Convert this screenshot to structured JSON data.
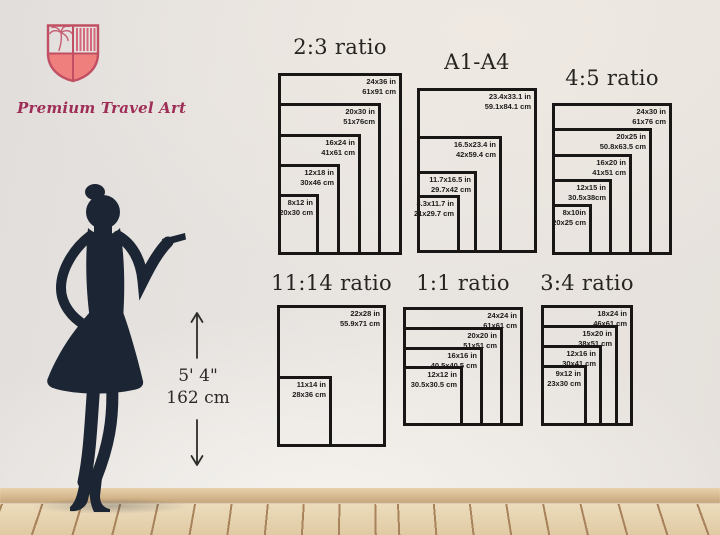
{
  "logo": {
    "brand": "Premium Travel Art",
    "icon": "shield-with-palm-tree-and-stripes",
    "shield_fill": "#ee7f7d",
    "shield_outline": "#c14f63",
    "text_color": "#9e2e57"
  },
  "figure": {
    "description": "woman-silhouette",
    "height_imperial": "5' 4\"",
    "height_metric": "162 cm",
    "silhouette_color": "#1c2533"
  },
  "icons": {
    "arrow_up": "↑",
    "arrow_down": "↓",
    "palm_tree": "palm-sketch"
  },
  "colors": {
    "wall": "#e7e3e0",
    "chart_line": "#181716",
    "label_text": "#1c1b1a",
    "floor_wood": "#e6d3b0",
    "floor_seam": "#a8835c",
    "baseboard": "#d5b88e"
  },
  "charts": [
    {
      "title": "2:3 ratio",
      "layout": {
        "left": 278,
        "top": 73,
        "width": 124,
        "height": 182,
        "title_top": 35
      },
      "sizes": [
        {
          "in": "24x36 in",
          "cm": "61x91 cm",
          "w": 24,
          "h": 36
        },
        {
          "in": "20x30 in",
          "cm": "51x76cm",
          "w": 20,
          "h": 30
        },
        {
          "in": "16x24 in",
          "cm": "41x61 cm",
          "w": 16,
          "h": 24
        },
        {
          "in": "12x18 in",
          "cm": "30x46 cm",
          "w": 12,
          "h": 18
        },
        {
          "in": "8x12 in",
          "cm": "20x30 cm",
          "w": 8,
          "h": 12
        }
      ]
    },
    {
      "title": "A1-A4",
      "layout": {
        "left": 417,
        "top": 88,
        "width": 120,
        "height": 165,
        "title_top": 50
      },
      "sizes": [
        {
          "in": "23.4x33.1 in",
          "cm": "59.1x84.1 cm",
          "w": 23.4,
          "h": 33.1
        },
        {
          "in": "16.5x23.4 in",
          "cm": "42x59.4 cm",
          "w": 16.5,
          "h": 23.4
        },
        {
          "in": "11.7x16.5 in",
          "cm": "29.7x42 cm",
          "w": 11.7,
          "h": 16.5
        },
        {
          "in": "8.3x11.7 in",
          "cm": "21x29.7 cm",
          "w": 8.3,
          "h": 11.7
        }
      ]
    },
    {
      "title": "4:5 ratio",
      "layout": {
        "left": 552,
        "top": 103,
        "width": 120,
        "height": 152,
        "title_top": 66
      },
      "sizes": [
        {
          "in": "24x30 in",
          "cm": "61x76 cm",
          "w": 24,
          "h": 30
        },
        {
          "in": "20x25 in",
          "cm": "50.8x63.5 cm",
          "w": 20,
          "h": 25
        },
        {
          "in": "16x20 in",
          "cm": "41x51 cm",
          "w": 16,
          "h": 20
        },
        {
          "in": "12x15 in",
          "cm": "30.5x38cm",
          "w": 12,
          "h": 15
        },
        {
          "in": "8x10in",
          "cm": "20x25 cm",
          "w": 8,
          "h": 10
        }
      ]
    },
    {
      "title": "11:14 ratio",
      "layout": {
        "left": 277,
        "top": 305,
        "width": 109,
        "height": 142,
        "title_top": 271
      },
      "sizes": [
        {
          "in": "22x28 in",
          "cm": "55.9x71 cm",
          "w": 22,
          "h": 28
        },
        {
          "in": "11x14 in",
          "cm": "28x36 cm",
          "w": 11,
          "h": 14
        }
      ]
    },
    {
      "title": "1:1 ratio",
      "layout": {
        "left": 403,
        "top": 307,
        "width": 120,
        "height": 119,
        "title_top": 271
      },
      "sizes": [
        {
          "in": "24x24 in",
          "cm": "61x61 cm",
          "w": 24,
          "h": 24
        },
        {
          "in": "20x20 in",
          "cm": "51x51 cm",
          "w": 20,
          "h": 20
        },
        {
          "in": "16x16 in",
          "cm": "40.5x40.5 cm",
          "w": 16,
          "h": 16
        },
        {
          "in": "12x12 in",
          "cm": "30.5x30.5 cm",
          "w": 12,
          "h": 12
        }
      ]
    },
    {
      "title": "3:4 ratio",
      "layout": {
        "left": 541,
        "top": 305,
        "width": 92,
        "height": 121,
        "title_top": 271
      },
      "sizes": [
        {
          "in": "18x24 in",
          "cm": "46x61 cm",
          "w": 18,
          "h": 24
        },
        {
          "in": "15x20 in",
          "cm": "38x51 cm",
          "w": 15,
          "h": 20
        },
        {
          "in": "12x16 in",
          "cm": "30x41 cm",
          "w": 12,
          "h": 16
        },
        {
          "in": "9x12 in",
          "cm": "23x30 cm",
          "w": 9,
          "h": 12
        }
      ]
    }
  ]
}
